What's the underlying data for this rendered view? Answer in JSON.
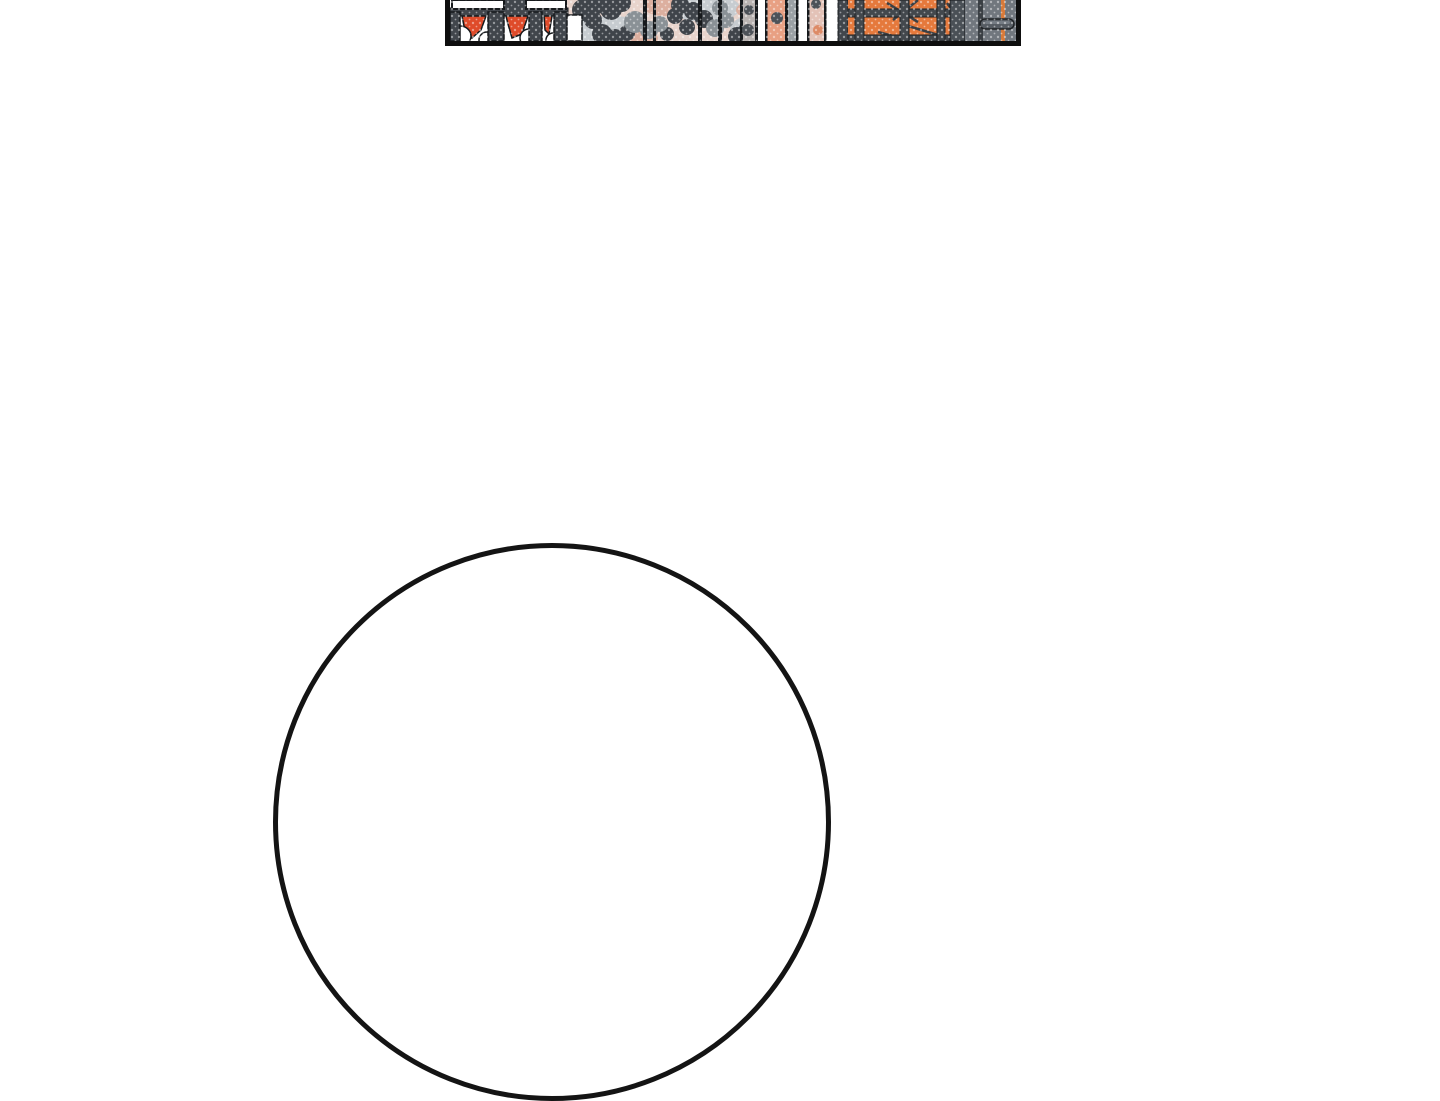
{
  "page": {
    "background": "#ffffff"
  },
  "comic": {
    "panel": {
      "border": "#0e0e0e"
    },
    "bubble": {
      "stroke": "#141414"
    },
    "colors": {
      "white": "#ffffff",
      "ink": "#16191c",
      "frame_gray": "#41464c",
      "dark_foliage": "#3f444a",
      "mid_gray": "#8a9196",
      "cloud_gray": "#c7ccd0",
      "halftone_pink": "#e8d4cc",
      "dusty_pink": "#dcaf9f",
      "pale_pink": "#e3c2b7",
      "salmon": "#e8a083",
      "salmon_deep": "#dd8a66",
      "red_orange": "#df4b2a",
      "orange": "#e5793c",
      "orange_line": "#d77a3a",
      "grid_gray": "#43484d",
      "branch_gray": "#3a3f44",
      "bar_gray": "#4a5056",
      "door_gray": "#71777e",
      "handle_gray": "#565c63",
      "handle_edge": "#1f2225",
      "strip_gray": "#9aa0a4",
      "taupe_gray": "#b9b3b1",
      "blotch_gray": "#4d5258",
      "highlight_gray": "#7d848c"
    }
  }
}
